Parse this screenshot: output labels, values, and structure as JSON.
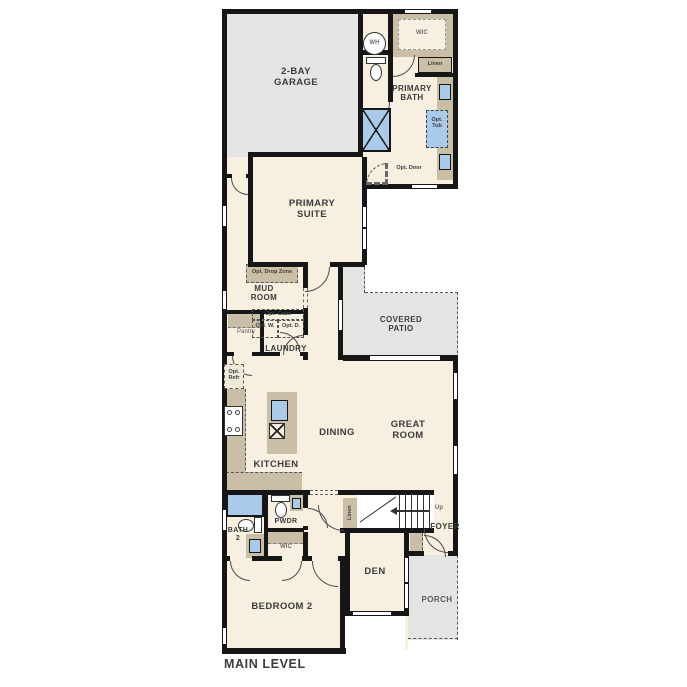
{
  "plan_title": "MAIN LEVEL",
  "colors": {
    "floor": "#f7efe0",
    "concrete": "#e4e4e2",
    "wall": "#161616",
    "casework": "#cabfa6",
    "fixture": "#a9cbe9",
    "label": "#3c3c3c"
  },
  "rooms": {
    "garage": {
      "label": "2-BAY GARAGE"
    },
    "wic_primary": {
      "label": "WIC"
    },
    "primary_bath": {
      "label": "PRIMARY BATH"
    },
    "primary_suite": {
      "label": "PRIMARY SUITE"
    },
    "mud_room": {
      "label": "MUD ROOM"
    },
    "pantry": {
      "label": "Pantry"
    },
    "laundry": {
      "label": "LAUNDRY"
    },
    "covered_patio": {
      "label": "COVERED PATIO"
    },
    "kitchen": {
      "label": "KITCHEN"
    },
    "dining": {
      "label": "DINING"
    },
    "great_room": {
      "label": "GREAT ROOM"
    },
    "bath2": {
      "label": "BATH 2"
    },
    "pwdr": {
      "label": "PWDR"
    },
    "wic_bedroom2": {
      "label": "WIC"
    },
    "foyer": {
      "label": "FOYER"
    },
    "den": {
      "label": "DEN"
    },
    "porch": {
      "label": "PORCH"
    },
    "bedroom2": {
      "label": "BEDROOM 2"
    }
  },
  "annotations": {
    "water_heater": "WH",
    "linen_primary": "Linen",
    "linen_stairs": "Linen",
    "opt_tub": "Opt. Tub",
    "opt_door": "Opt. Door",
    "opt_drop_zone": "Opt. Drop Zone",
    "opt_cabs": "Opt. Cabs",
    "opt_washer": "Opt. W.",
    "opt_dryer": "Opt. D.",
    "opt_refr": "Opt. Refr",
    "stairs_up": "Up"
  }
}
